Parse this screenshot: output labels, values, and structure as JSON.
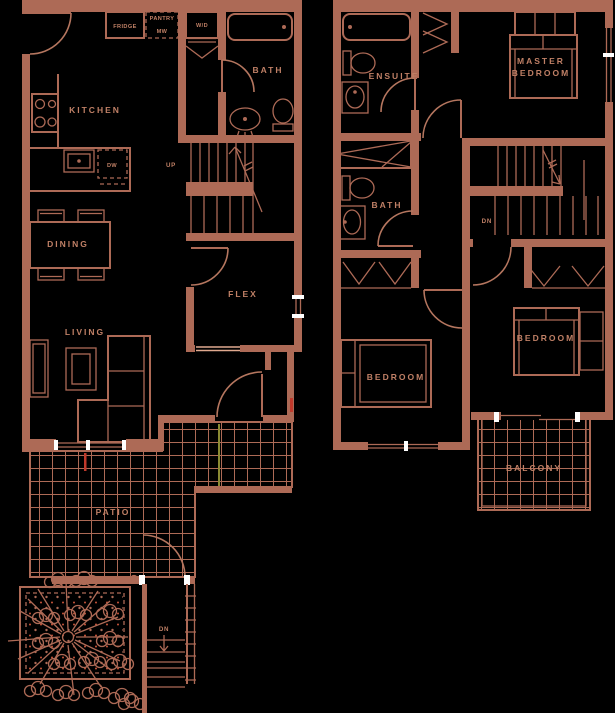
{
  "colors": {
    "background": "#000000",
    "line": "#ad6a56",
    "line_light": "#e0a98f",
    "label": "#c08066",
    "window_tick": "#ffffff",
    "accent_red": "#c0392b",
    "accent_olive": "#8a8a33"
  },
  "floor1": {
    "rooms": {
      "kitchen": "KITCHEN",
      "dining": "DINING",
      "living": "LIVING",
      "flex": "FLEX",
      "bath": "BATH",
      "patio": "PATIO"
    },
    "fixtures": {
      "fridge": "FRIDGE",
      "pantry": "PANTRY",
      "microwave": "MW",
      "washer_dryer": "W/D",
      "dishwasher": "DW"
    },
    "stairs": {
      "up": "UP",
      "down": "DN"
    }
  },
  "floor2": {
    "rooms": {
      "master_line1": "MASTER",
      "master_line2": "BEDROOM",
      "ensuite": "ENSUITE",
      "bath": "BATH",
      "bedroom_left": "BEDROOM",
      "bedroom_right": "BEDROOM",
      "balcony": "BALCONY"
    },
    "stairs": {
      "down": "DN"
    }
  }
}
